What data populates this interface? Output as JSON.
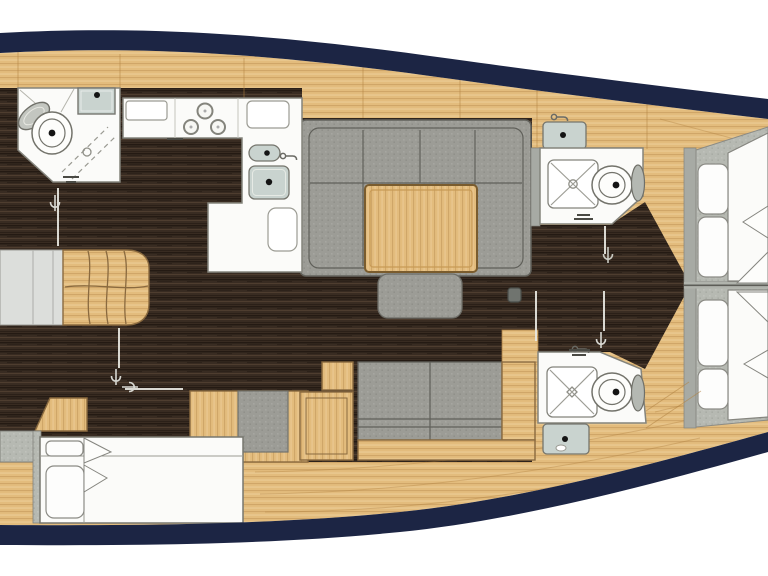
{
  "diagram": {
    "type": "yacht-interior-floor-plan",
    "orientation": {
      "bow": "right",
      "stern": "left"
    },
    "colors": {
      "hull_navy": "#1c2544",
      "outside_white": "#ffffff",
      "wood_deck": "#e3bc7d",
      "floor_dark": "#392c22",
      "sofa_gray": "#9c9c96",
      "mattress_gray": "#b6b9b2",
      "bulkhead_gray": "#a7aaa4",
      "room_white": "#fbfbf9",
      "sink_gray": "#c9d3cf",
      "landing_gray": "#dcdedb"
    },
    "rooms": [
      {
        "id": "forward-head",
        "label": "forward head with toilet, basin and shower"
      },
      {
        "id": "galley",
        "label": "L-shaped galley with stove and double sink"
      },
      {
        "id": "saloon",
        "label": "saloon with U-sofa, table and ottoman"
      },
      {
        "id": "companionway",
        "label": "companionway steps and landing"
      },
      {
        "id": "aft-cabin",
        "label": "aft cabin double berth"
      },
      {
        "id": "starboard-forward-head",
        "label": "starboard forward head"
      },
      {
        "id": "starboard-aft-head",
        "label": "starboard aft head"
      },
      {
        "id": "bow-cabin",
        "label": "bow cabin V-berth"
      }
    ],
    "fixtures": [
      "toilet",
      "shower-pan",
      "washbasin",
      "three-burner-stove",
      "double-galley-sink",
      "saloon-table",
      "u-shaped-sofa",
      "ottoman",
      "settee",
      "double-berth",
      "v-berth-pillows",
      "deck-hatch",
      "companionway-steps",
      "door-swing-markers"
    ],
    "counts": {
      "toilets": 3,
      "shower_pans": 3,
      "washbasins": 4,
      "stove_burners": 3,
      "berth_pillows": 6
    }
  }
}
